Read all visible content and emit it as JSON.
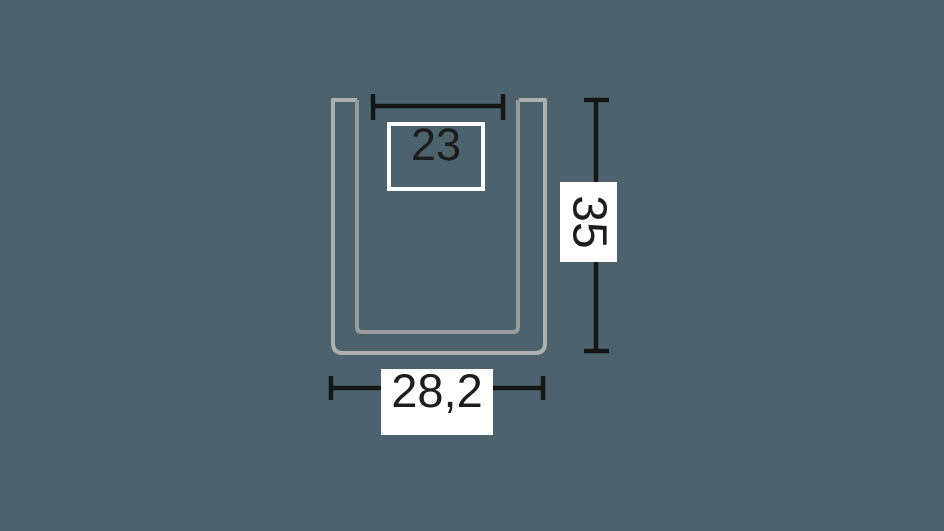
{
  "diagram": {
    "description": "Technical cross-section drawing of a U-shaped channel profile with three dimension callouts",
    "profile_shape": "u-channel",
    "dimensions": {
      "inner_width": {
        "value": "23",
        "orientation": "horizontal",
        "position": "top"
      },
      "height": {
        "value": "35",
        "orientation": "vertical",
        "position": "right"
      },
      "outer_width": {
        "value": "28,2",
        "orientation": "horizontal",
        "position": "bottom"
      }
    }
  },
  "colors": {
    "bg": "#4c636d",
    "profile-outer": "#aeb0ae",
    "profile-inner": "#9b9d9c",
    "dim": "#151515",
    "label-bg": "#ffffff",
    "label-border": "#ffffff",
    "label-text": "#1d1d1d"
  }
}
